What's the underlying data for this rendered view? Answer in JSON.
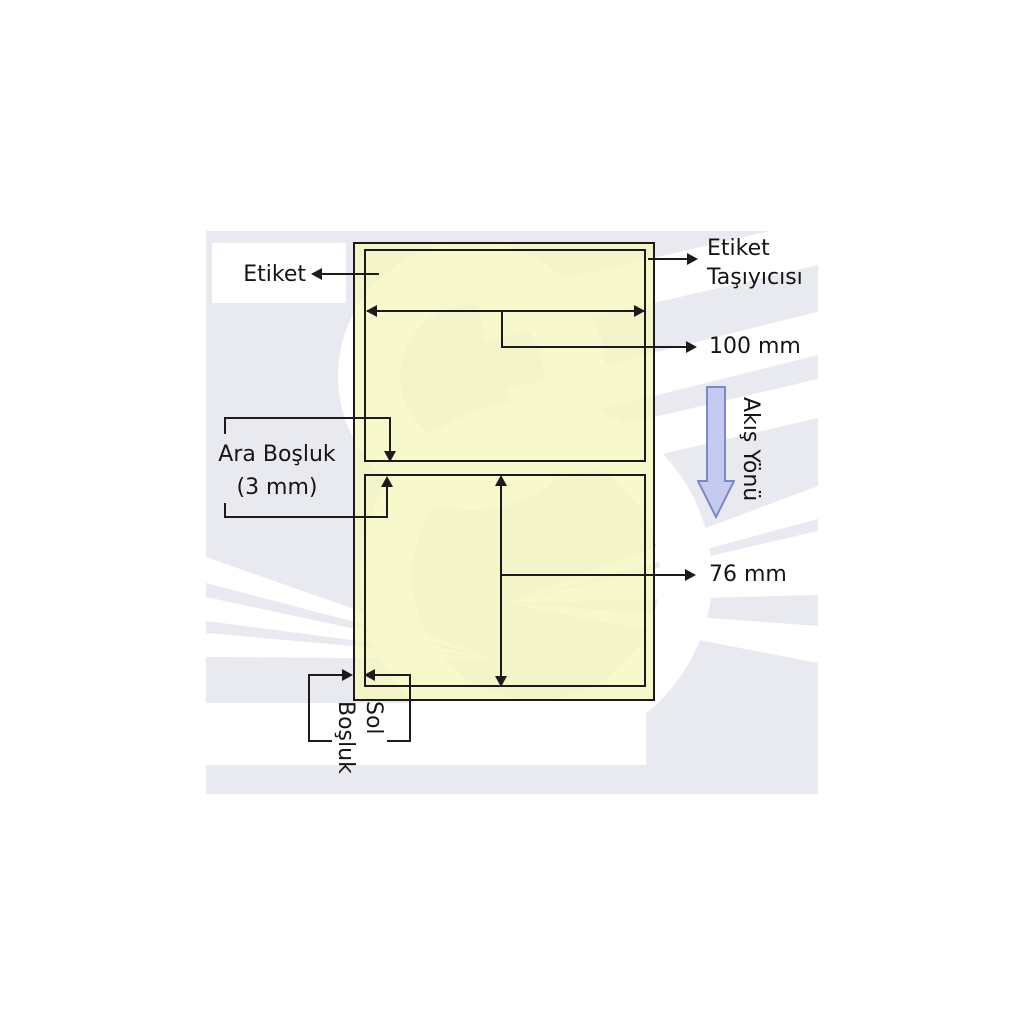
{
  "diagram": {
    "labels": {
      "label": "Etiket",
      "carrier": {
        "line1": "Etiket",
        "line2": "Taşıyıcısı"
      },
      "width_dimension": "100 mm",
      "gap": {
        "line1": "Ara Boşluk",
        "line2": "(3 mm)"
      },
      "height_dimension": "76 mm",
      "left_margin": {
        "line1": "Sol",
        "line2": "Boşluk"
      },
      "flow_direction": "Akış Yönü"
    },
    "values": {
      "label_width_mm": 100,
      "label_height_mm": 76,
      "gap_mm": 3
    },
    "colors": {
      "panel_background": "#e8eaf0",
      "watermark": "#ffffff",
      "carrier_fill": "rgba(246,246,193,0.8)",
      "line": "#1b1b1b",
      "text": "#151515",
      "flow_arrow_fill": "#c5cbf0",
      "flow_arrow_stroke": "#7e88c4"
    }
  }
}
